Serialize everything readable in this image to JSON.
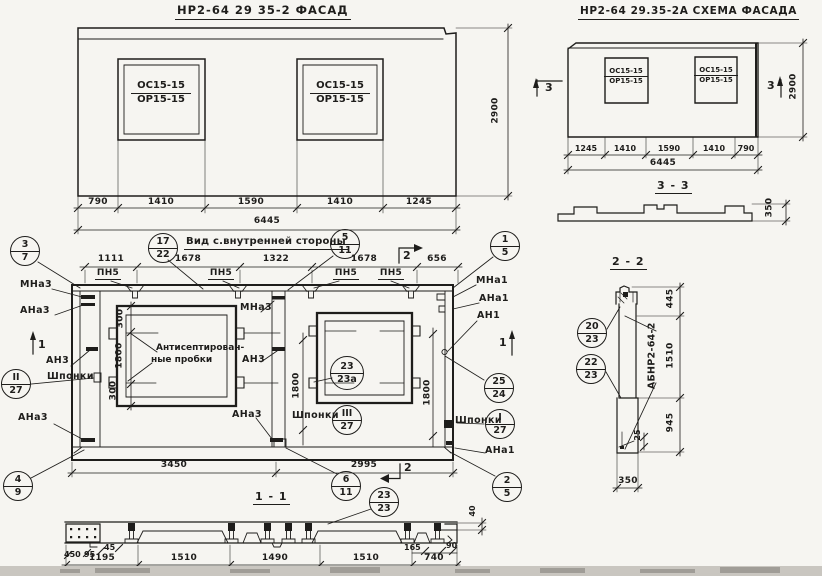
{
  "facade": {
    "title": "НР2-64 29 35-2 ФАСАД",
    "window_top": "ОС15-15",
    "window_bottom": "ОР15-15",
    "dims": [
      "790",
      "1410",
      "1590",
      "1410",
      "1245"
    ],
    "total": "6445",
    "height": "2900"
  },
  "schema": {
    "title": "НР2-64 29.35-2А СХЕМА ФАСАДА",
    "window_top": "ОС15-15",
    "window_bottom": "ОР15-15",
    "dims": [
      "1245",
      "1410",
      "1590",
      "1410",
      "790"
    ],
    "total": "6445",
    "height": "2900",
    "marker": "3"
  },
  "sec33": {
    "title": "3 - 3",
    "height": "350"
  },
  "inner": {
    "title": "Вид с.внутренней стороны",
    "dims_top": [
      "1111",
      "1678",
      "1322",
      "1678",
      "656"
    ],
    "pn5": "ПН5",
    "mna3": "МНа3",
    "ana3": "АНа3",
    "an3": "АН3",
    "mna1": "МНа1",
    "ana1": "АНа1",
    "an1": "АН1",
    "shponki": "Шпонки",
    "plugs_line1": "Антисептирован-",
    "plugs_line2": "ные пробки",
    "d300": "300",
    "d1800": "1800",
    "d3450": "3450",
    "d2995": "2995",
    "marker1": "1",
    "marker2": "2"
  },
  "sec11": {
    "title": "1 - 1",
    "dims": [
      "1195",
      "1510",
      "1490",
      "1510",
      "740"
    ],
    "d450": "450",
    "d95": "95",
    "d45": "45",
    "d165": "165",
    "d90": "90",
    "d40": "40"
  },
  "sec22": {
    "title": "2 - 2",
    "stamp": "АБНР2-64-2",
    "d445": "445",
    "d1510": "1510",
    "d945": "945",
    "d25": "25",
    "d350": "350"
  },
  "balloons": {
    "f3_7": {
      "t": "3",
      "b": "7"
    },
    "f17_22": {
      "t": "17",
      "b": "22"
    },
    "f5_11": {
      "t": "5",
      "b": "11"
    },
    "f1_5": {
      "t": "1",
      "b": "5"
    },
    "fII_27": {
      "t": "II",
      "b": "27"
    },
    "fIII_27": {
      "t": "III",
      "b": "27"
    },
    "fI_27": {
      "t": "I",
      "b": "27"
    },
    "f25_24": {
      "t": "25",
      "b": "24"
    },
    "f23_23a": {
      "t": "23",
      "b": "23а"
    },
    "f4_9": {
      "t": "4",
      "b": "9"
    },
    "f6_11": {
      "t": "6",
      "b": "11"
    },
    "f2_5": {
      "t": "2",
      "b": "5"
    },
    "f23_23": {
      "t": "23",
      "b": "23"
    },
    "f20_23": {
      "t": "20",
      "b": "23"
    },
    "f22_23": {
      "t": "22",
      "b": "23"
    }
  }
}
